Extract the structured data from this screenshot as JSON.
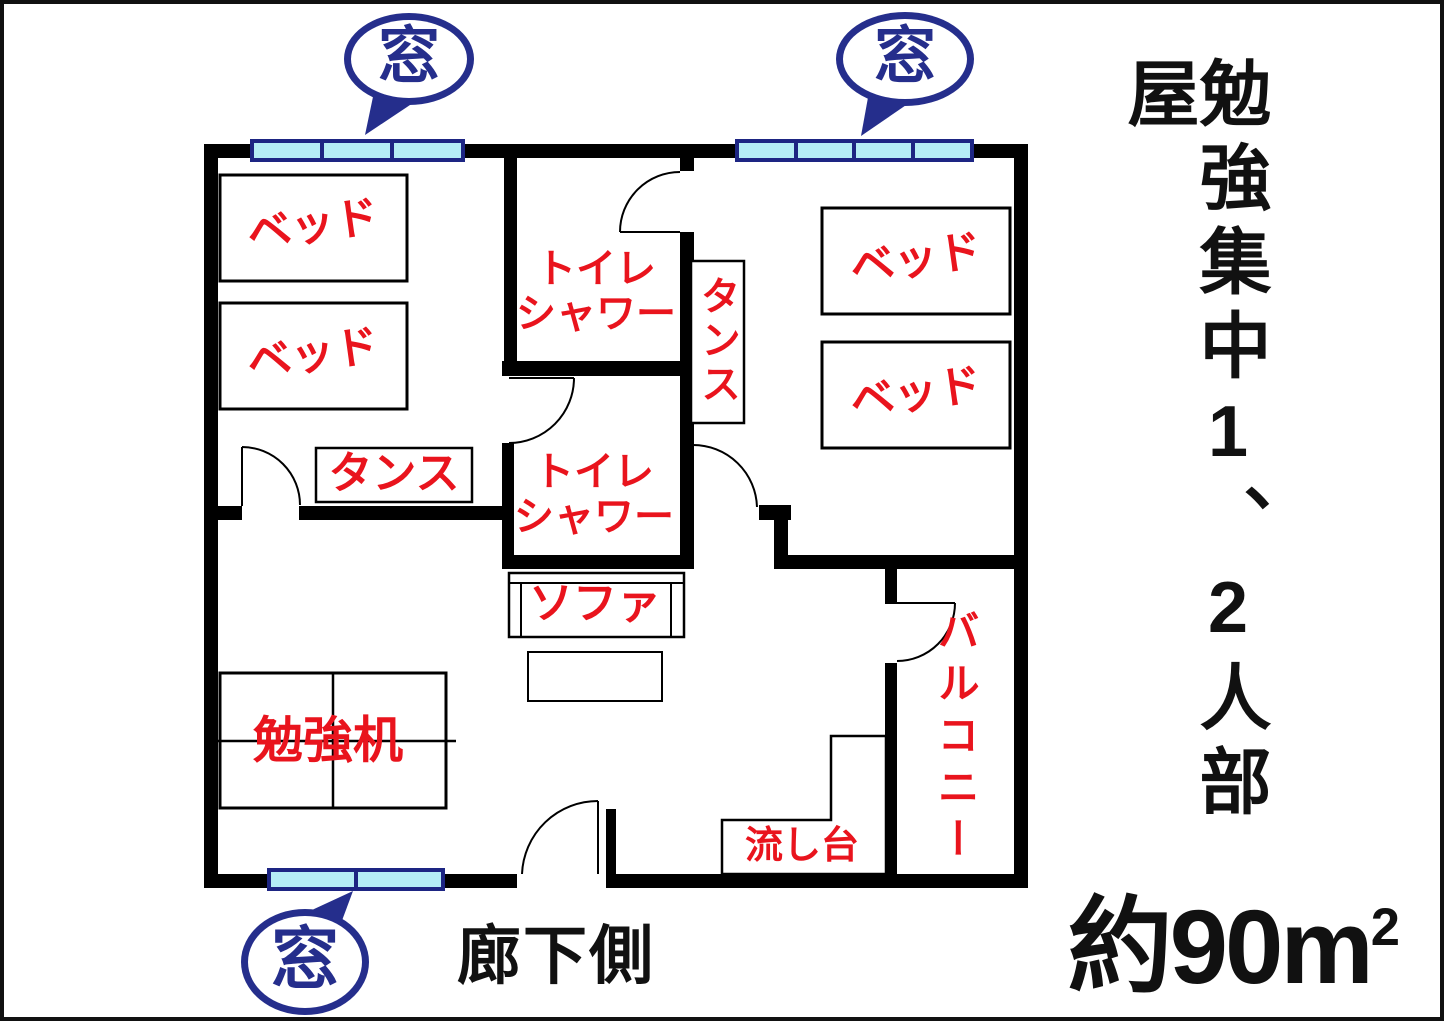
{
  "colors": {
    "wall": "#000000",
    "label_red": "#e9141d",
    "navy": "#252e8c",
    "window_fill": "#b5edf6",
    "background": "#ffffff"
  },
  "windows": {
    "label": "窓"
  },
  "rooms": {
    "bedroom_left": {
      "bed_1": "ベッド",
      "bed_2": "ベッド",
      "dresser": "タンス"
    },
    "bedroom_right": {
      "bed_1": "ベッド",
      "bed_2": "ベッド",
      "dresser": "タンス"
    },
    "bathroom_upper": {
      "label": "トイレ\nシャワー"
    },
    "bathroom_lower": {
      "label": "トイレ\nシャワー"
    },
    "living_area": {
      "sofa": "ソファ",
      "study_desk": "勉強机",
      "sink": "流し台"
    },
    "balcony": {
      "label": "バルコニー"
    }
  },
  "annotations": {
    "corridor_side": "廊下側",
    "sidebar_title": "勉強集中1、2人部屋",
    "area_value": "約90m",
    "area_superscript": "2"
  }
}
